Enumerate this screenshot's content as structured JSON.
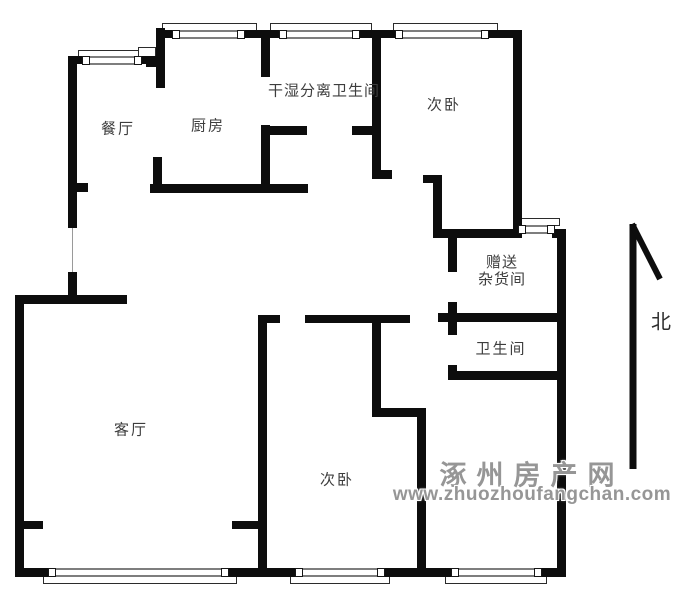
{
  "labels": {
    "dining": "餐厅",
    "kitchen": "厨房",
    "dry_wet_bathroom": "干湿分离卫生间",
    "bedroom_top": "次卧",
    "storage_line1": "赠送",
    "storage_line2": "杂货间",
    "bathroom": "卫生间",
    "living": "客厅",
    "bedroom_bottom": "次卧",
    "north": "北"
  },
  "watermark": {
    "site_name": "涿州房产网",
    "site_url": "www.zhuozhoufangchan.com"
  },
  "floorplan": {
    "wall_color": "#0d0d0d",
    "walls": [
      [
        68,
        56,
        18,
        8
      ],
      [
        140,
        56,
        25,
        8
      ],
      [
        68,
        56,
        9,
        172
      ],
      [
        77,
        183,
        11,
        9
      ],
      [
        68,
        272,
        9,
        31
      ],
      [
        15,
        295,
        112,
        9
      ],
      [
        15,
        295,
        9,
        282
      ],
      [
        15,
        521,
        28,
        8
      ],
      [
        156,
        28,
        9,
        60
      ],
      [
        153,
        157,
        9,
        35
      ],
      [
        156,
        30,
        18,
        8
      ],
      [
        243,
        30,
        27,
        8
      ],
      [
        261,
        33,
        9,
        44
      ],
      [
        261,
        125,
        9,
        67
      ],
      [
        150,
        184,
        158,
        9
      ],
      [
        270,
        30,
        11,
        8
      ],
      [
        358,
        30,
        23,
        8
      ],
      [
        372,
        31,
        9,
        146
      ],
      [
        372,
        170,
        20,
        9
      ],
      [
        261,
        126,
        46,
        9
      ],
      [
        352,
        126,
        29,
        9
      ],
      [
        381,
        30,
        16,
        8
      ],
      [
        487,
        30,
        34,
        8
      ],
      [
        513,
        30,
        9,
        208
      ],
      [
        423,
        175,
        19,
        8
      ],
      [
        433,
        175,
        9,
        63
      ],
      [
        433,
        229,
        88,
        9
      ],
      [
        552,
        229,
        14,
        9
      ],
      [
        448,
        229,
        9,
        43
      ],
      [
        448,
        302,
        9,
        33
      ],
      [
        448,
        365,
        9,
        14
      ],
      [
        438,
        313,
        128,
        9
      ],
      [
        448,
        371,
        118,
        9
      ],
      [
        557,
        229,
        9,
        348
      ],
      [
        258,
        315,
        22,
        8
      ],
      [
        305,
        315,
        105,
        8
      ],
      [
        258,
        315,
        9,
        262
      ],
      [
        232,
        521,
        26,
        8
      ],
      [
        372,
        323,
        9,
        93
      ],
      [
        372,
        408,
        53,
        9
      ],
      [
        417,
        408,
        9,
        169
      ],
      [
        15,
        568,
        40,
        9
      ],
      [
        227,
        568,
        70,
        9
      ],
      [
        383,
        568,
        70,
        9
      ],
      [
        540,
        568,
        26,
        9
      ],
      [
        146,
        57,
        11,
        10
      ]
    ],
    "windows": [
      [
        84,
        56,
        56
      ],
      [
        174,
        30,
        69
      ],
      [
        281,
        30,
        77
      ],
      [
        397,
        30,
        90
      ],
      [
        520,
        225,
        33
      ],
      [
        50,
        568,
        177
      ],
      [
        297,
        568,
        86
      ],
      [
        453,
        568,
        87
      ]
    ],
    "bays": [
      [
        78,
        50,
        72,
        7
      ],
      [
        162,
        23,
        95,
        8
      ],
      [
        270,
        23,
        102,
        8
      ],
      [
        393,
        23,
        105,
        8
      ],
      [
        513,
        218,
        47,
        8
      ],
      [
        43,
        576,
        194,
        8
      ],
      [
        290,
        576,
        100,
        8
      ],
      [
        445,
        576,
        102,
        8
      ],
      [
        138,
        47,
        18,
        11
      ]
    ],
    "thin_lines": [
      [
        72,
        228,
        1,
        45
      ]
    ]
  }
}
